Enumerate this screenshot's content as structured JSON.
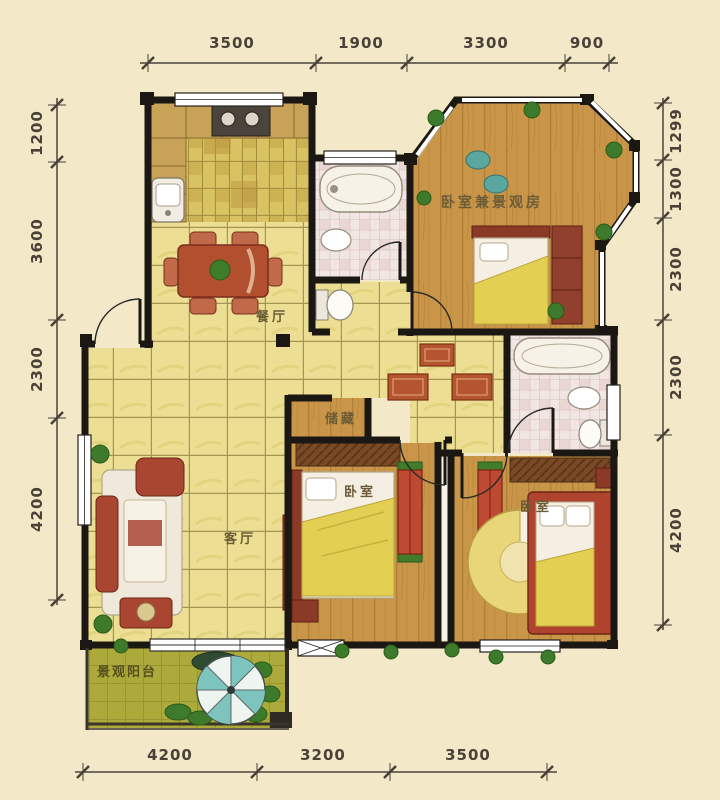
{
  "title": "residential-floor-plan",
  "rooms": {
    "dining": "餐厅",
    "living": "客厅",
    "storage": "储藏",
    "bedroom_view": "卧室兼景观房",
    "bedroom_left": "卧室",
    "bedroom_right": "卧室",
    "balcony": "景观阳台"
  },
  "dims": {
    "top": [
      "3500",
      "1900",
      "3300",
      "900"
    ],
    "bottom": [
      "4200",
      "3200",
      "3500"
    ],
    "left": [
      "1200",
      "3600",
      "2300",
      "4200"
    ],
    "right": [
      "1299",
      "1300",
      "2300",
      "2300",
      "4200"
    ]
  },
  "colors": {
    "background": "#f3e8c7",
    "wall": "#1b1713",
    "wood_floor": "#c89549",
    "tile_floor": "#ecdf93",
    "kitchen_floor": "#d8c261",
    "bath_floor": "#f2e6e2",
    "balcony_floor": "#adaa3c",
    "furniture_red": "#a84632",
    "blanket_yellow": "#e3cf52",
    "plant_green": "#3d7a2b",
    "parasol_teal": "#7cc4bd",
    "dimension": "#4a4238"
  }
}
